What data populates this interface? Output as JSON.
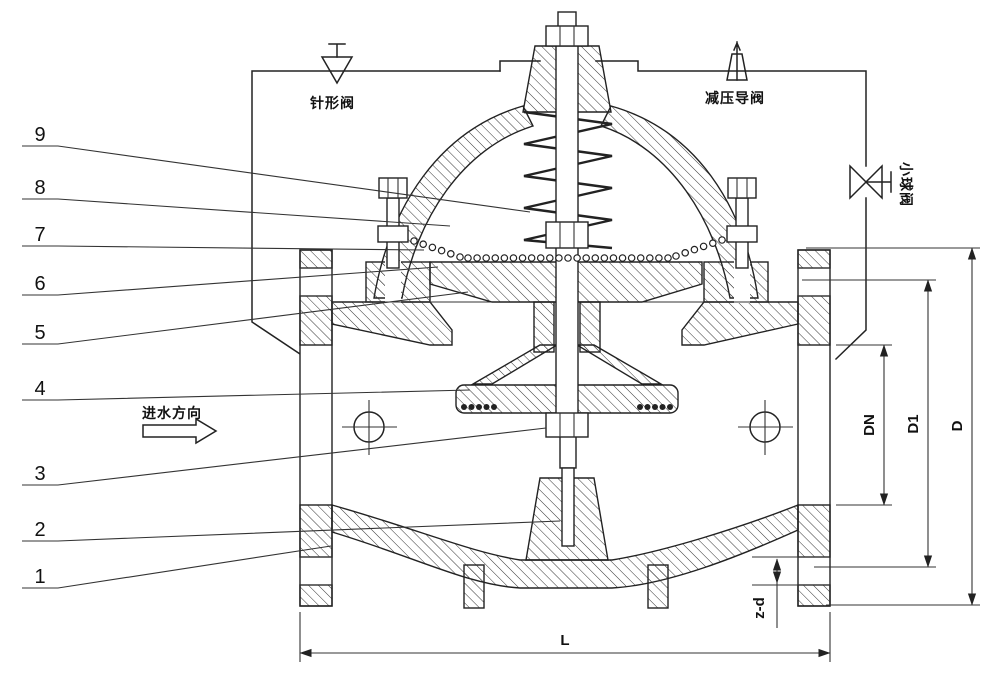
{
  "colors": {
    "line": "#222222",
    "background": "#ffffff"
  },
  "schematic": {
    "needle_valve_label": "针形阀",
    "pilot_valve_label": "减压导阀",
    "ball_valve_label": "小球阀",
    "flow_direction_label": "进水方向"
  },
  "part_numbers": [
    "1",
    "2",
    "3",
    "4",
    "5",
    "6",
    "7",
    "8",
    "9"
  ],
  "dimensions": {
    "bore": "DN",
    "bolt_circle": "D1",
    "flange_od": "D",
    "bolt_holes": "z-d",
    "face_to_face": "L"
  }
}
